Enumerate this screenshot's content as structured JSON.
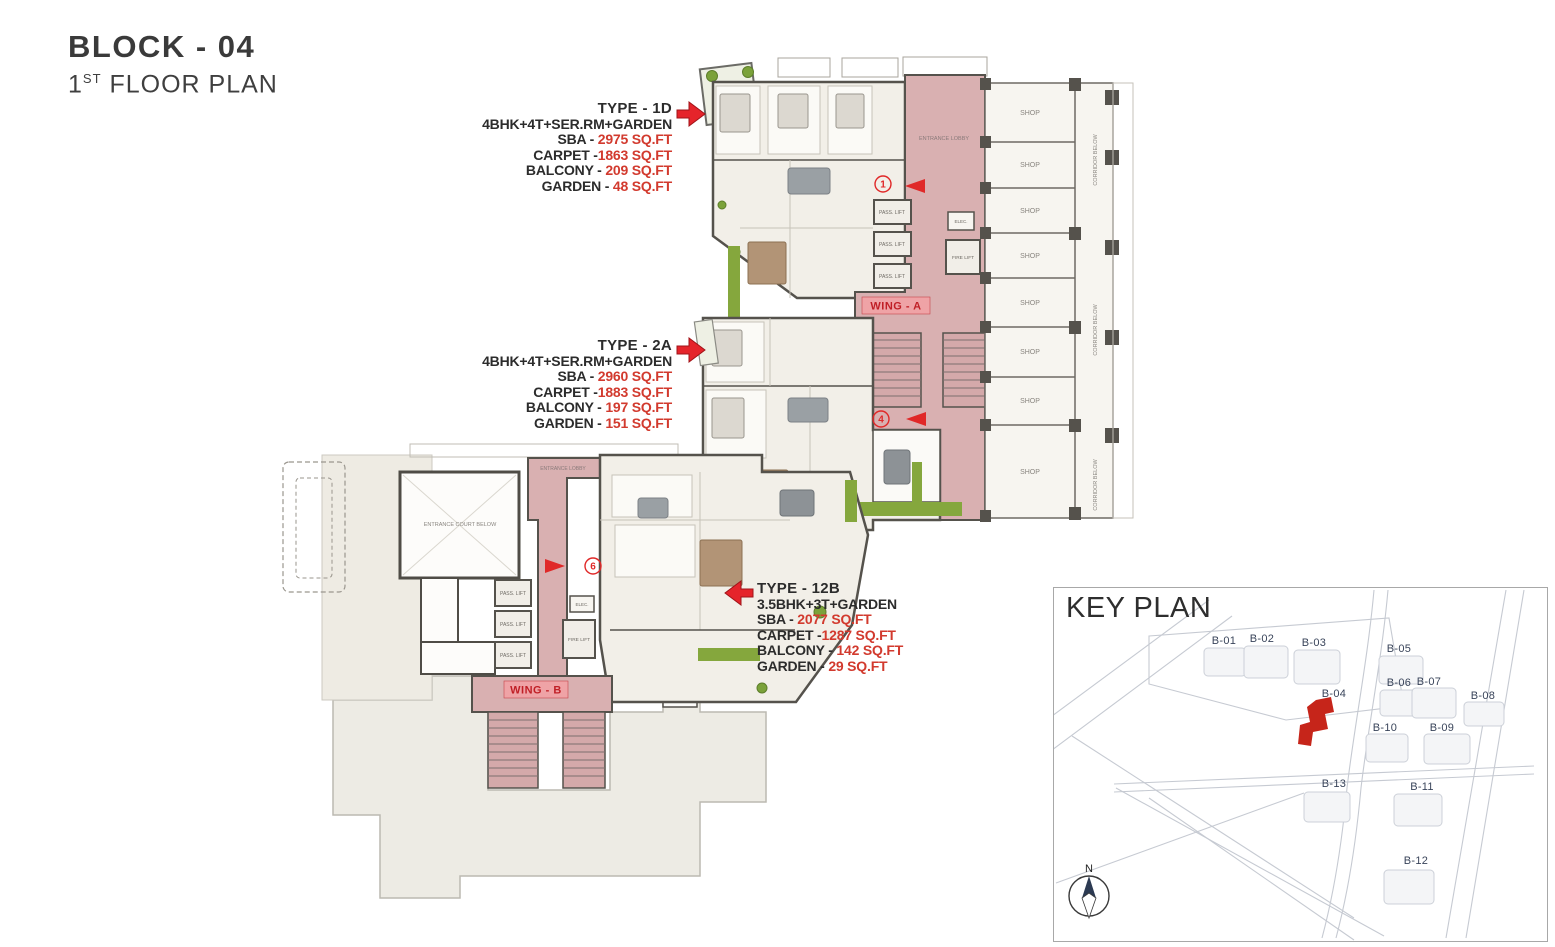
{
  "title": {
    "block": "BLOCK - 04",
    "floor_number": "1",
    "floor_ordinal": "ST",
    "floor_rest": " FLOOR PLAN"
  },
  "units": [
    {
      "heading": "TYPE - 1D",
      "config": "4BHK+4T+SER.RM+GARDEN",
      "specs": [
        {
          "label": "SBA - ",
          "value": "2975 SQ.FT"
        },
        {
          "label": "CARPET -",
          "value": "1863 SQ.FT"
        },
        {
          "label": "BALCONY - ",
          "value": "209 SQ.FT"
        },
        {
          "label": "GARDEN - ",
          "value": "48 SQ.FT"
        }
      ]
    },
    {
      "heading": "TYPE - 2A",
      "config": "4BHK+4T+SER.RM+GARDEN",
      "specs": [
        {
          "label": "SBA - ",
          "value": "2960 SQ.FT"
        },
        {
          "label": "CARPET -",
          "value": "1883 SQ.FT"
        },
        {
          "label": "BALCONY - ",
          "value": "197 SQ.FT"
        },
        {
          "label": "GARDEN - ",
          "value": "151 SQ.FT"
        }
      ]
    },
    {
      "heading": "TYPE - 12B",
      "config": "3.5BHK+3T+GARDEN",
      "specs": [
        {
          "label": "SBA - ",
          "value": "2077 SQ.FT"
        },
        {
          "label": "CARPET -",
          "value": "1287 SQ.FT"
        },
        {
          "label": "BALCONY - ",
          "value": "142 SQ.FT"
        },
        {
          "label": "GARDEN - ",
          "value": "29 SQ.FT"
        }
      ]
    }
  ],
  "plan": {
    "wing_a": "WING - A",
    "wing_b": "WING - B",
    "shop": "SHOP",
    "pass_lift": "PASS. LIFT",
    "fire_lift": "FIRE LIFT",
    "elec": "ELEC.",
    "entrance_lobby": "ENTRANCE LOBBY",
    "entrance_court": "ENTRANCE COURT BELOW",
    "corridor_below": "CORRIDOR BELOW",
    "unit_markers": [
      "1",
      "4",
      "6"
    ]
  },
  "key_plan": {
    "title": "KEY PLAN",
    "compass": "N",
    "highlight": "B-04",
    "blocks": [
      "B-01",
      "B-02",
      "B-03",
      "B-04",
      "B-05",
      "B-06",
      "B-07",
      "B-08",
      "B-09",
      "B-10",
      "B-11",
      "B-12",
      "B-13"
    ]
  },
  "colors": {
    "accent_red": "#e5242b",
    "value_red": "#d23a2e",
    "lobby_pink": "#d9b0b1",
    "label_pink": "#efa3a6",
    "garden_green": "#85a73d",
    "wall_dark": "#55524c"
  }
}
